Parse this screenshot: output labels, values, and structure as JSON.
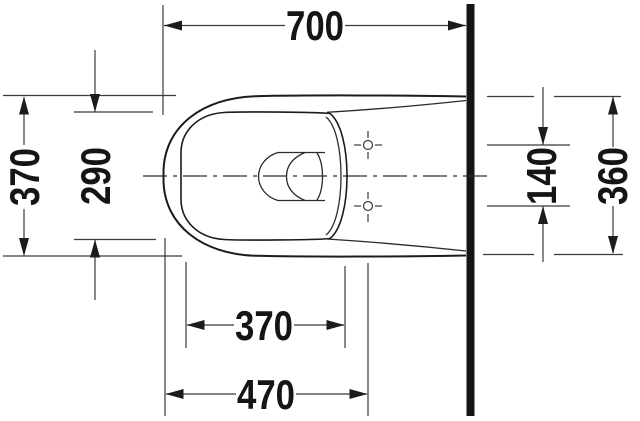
{
  "drawing": {
    "subject": "wall-hung-toilet-top-view-technical-drawing",
    "background_color": "#ffffff",
    "line_color": "#1c1c1c",
    "dimension_line_color": "#3a3a3a",
    "text_color": "#151515",
    "wall_color": "#151515",
    "dimensions": [
      {
        "id": "overall-length",
        "label": "700",
        "orientation": "horizontal",
        "position": "top"
      },
      {
        "id": "outer-width-front",
        "label": "370",
        "orientation": "vertical",
        "position": "left-outer"
      },
      {
        "id": "bowl-width",
        "label": "290",
        "orientation": "vertical",
        "position": "left-inner"
      },
      {
        "id": "fixing-hole-spacing",
        "label": "140",
        "orientation": "vertical",
        "position": "right-inner"
      },
      {
        "id": "width-at-wall",
        "label": "360",
        "orientation": "vertical",
        "position": "right-outer"
      },
      {
        "id": "bowl-opening-length",
        "label": "370",
        "orientation": "horizontal",
        "position": "bottom-inner"
      },
      {
        "id": "front-to-fixing-holes",
        "label": "470",
        "orientation": "horizontal",
        "position": "bottom-outer"
      }
    ],
    "symbols": {
      "fixing_holes_count": 2,
      "fixing_hole_symbol": "crosshair-circle",
      "wall_symbol": "thick-vertical-bar",
      "centerline_style": "dash-dot"
    }
  }
}
